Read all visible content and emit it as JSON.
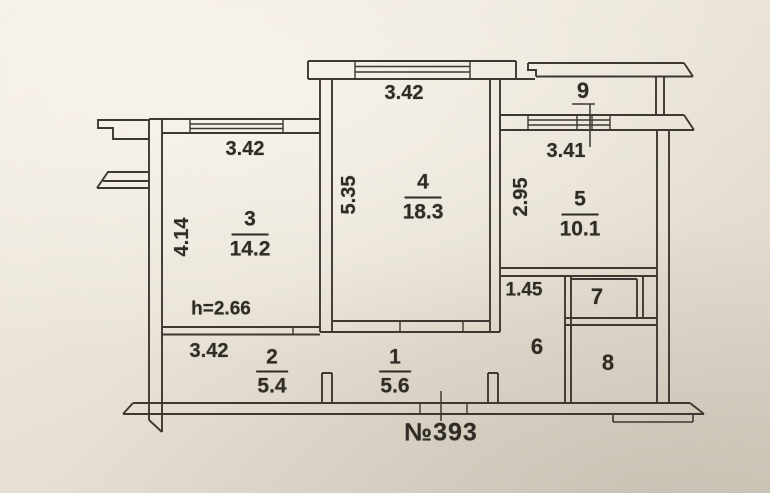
{
  "plan": {
    "apartment_number": "№393",
    "ceiling_height": "h=2.66",
    "line_color": "#3d3831",
    "paper_color": "#ece6db",
    "rooms": {
      "r1": {
        "number": "1",
        "area": "5.6"
      },
      "r2": {
        "number": "2",
        "area": "5.4"
      },
      "r3": {
        "number": "3",
        "area": "14.2"
      },
      "r4": {
        "number": "4",
        "area": "18.3"
      },
      "r5": {
        "number": "5",
        "area": "10.1"
      },
      "r6": {
        "number": "6"
      },
      "r7": {
        "number": "7"
      },
      "r8": {
        "number": "8"
      },
      "r9": {
        "number": "9"
      }
    },
    "dims": {
      "room3_width": "3.42",
      "room4_width": "3.42",
      "room5_width": "3.41",
      "room3_depth": "4.14",
      "room4_depth": "5.35",
      "room5_depth": "2.95",
      "closet_width": "1.45",
      "hall_width": "3.42"
    }
  }
}
